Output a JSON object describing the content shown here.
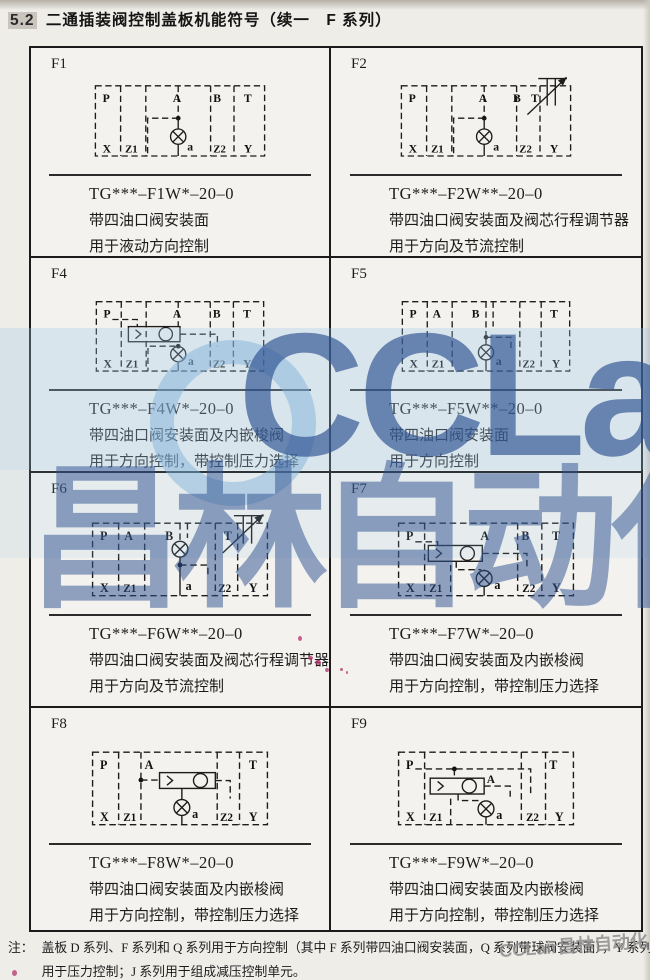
{
  "page": {
    "section_number": "5.2",
    "title": "二通插装阀控制盖板机能符号（续一　F 系列）",
    "note_label": "注：",
    "note_line1": "盖板 D 系列、F 系列和 Q 系列用于方向控制（其中 F 系列带四油口阀安装面，Q 系列带球阀安装面），Y 系列",
    "note_line2": "用于压力控制；J 系列用于组成减压控制单元。",
    "watermark_word": "CCLair",
    "watermark_cn": "昌林自动化",
    "watermark_corner": "CCLair昌林自动化"
  },
  "colors": {
    "watermark_blue": "#2d5191",
    "band_blue": "#9bc8e8",
    "pen_red": "#b83d72",
    "paper": "#efede8",
    "ink": "#1c1c1c"
  },
  "cells": [
    {
      "id": "F1",
      "code": "TG***–F1W*–20–0",
      "desc1": "带四油口阀安装面",
      "desc2": "用于液动方向控制",
      "ports": {
        "p": "P",
        "a": "A",
        "b": "B",
        "t": "T",
        "x": "X",
        "z1": "Z1",
        "z2": "Z2",
        "y": "Y",
        "g": "a"
      }
    },
    {
      "id": "F2",
      "code": "TG***–F2W**–20–0",
      "desc1": "带四油口阀安装面及阀芯行程调节器",
      "desc2": "用于方向及节流控制",
      "ports": {
        "p": "P",
        "a": "A",
        "b": "B",
        "t": "T",
        "x": "X",
        "z1": "Z1",
        "z2": "Z2",
        "y": "Y",
        "g": "a"
      }
    },
    {
      "id": "F4",
      "code": "TG***–F4W*–20–0",
      "desc1": "带四油口阀安装面及内嵌梭阀",
      "desc2": "用于方向控制，带控制压力选择",
      "ports": {
        "p": "P",
        "a": "A",
        "b": "B",
        "t": "T",
        "x": "X",
        "z1": "Z1",
        "z2": "Z2",
        "y": "Y",
        "g": "a"
      }
    },
    {
      "id": "F5",
      "code": "TG***–F5W**–20–0",
      "desc1": "带四油口阀安装面",
      "desc2": "用于方向控制",
      "ports": {
        "p": "P",
        "a": "A",
        "b": "B",
        "t": "T",
        "x": "X",
        "z1": "Z1",
        "z2": "Z2",
        "y": "Y",
        "g": "a"
      }
    },
    {
      "id": "F6",
      "code": "TG***–F6W**–20–0",
      "desc1": "带四油口阀安装面及阀芯行程调节器",
      "desc2": "用于方向及节流控制",
      "ports": {
        "p": "P",
        "a": "A",
        "b": "B",
        "t": "T",
        "x": "X",
        "z1": "Z1",
        "z2": "Z2",
        "y": "Y",
        "g": "a"
      }
    },
    {
      "id": "F7",
      "code": "TG***–F7W*–20–0",
      "desc1": "带四油口阀安装面及内嵌梭阀",
      "desc2": "用于方向控制，带控制压力选择",
      "ports": {
        "p": "P",
        "a": "A",
        "b": "B",
        "t": "T",
        "x": "X",
        "z1": "Z1",
        "z2": "Z2",
        "y": "Y",
        "g": "a"
      }
    },
    {
      "id": "F8",
      "code": "TG***–F8W*–20–0",
      "desc1": "带四油口阀安装面及内嵌梭阀",
      "desc2": "用于方向控制，带控制压力选择",
      "ports": {
        "p": "P",
        "a": "A",
        "t": "T",
        "x": "X",
        "z1": "Z1",
        "z2": "Z2",
        "y": "Y",
        "g": "a"
      }
    },
    {
      "id": "F9",
      "code": "TG***–F9W*–20–0",
      "desc1": "带四油口阀安装面及内嵌梭阀",
      "desc2": "用于方向控制，带控制压力选择",
      "ports": {
        "p": "P",
        "a": "A",
        "t": "T",
        "x": "X",
        "z1": "Z1",
        "z2": "Z2",
        "y": "Y",
        "g": "a"
      }
    }
  ]
}
